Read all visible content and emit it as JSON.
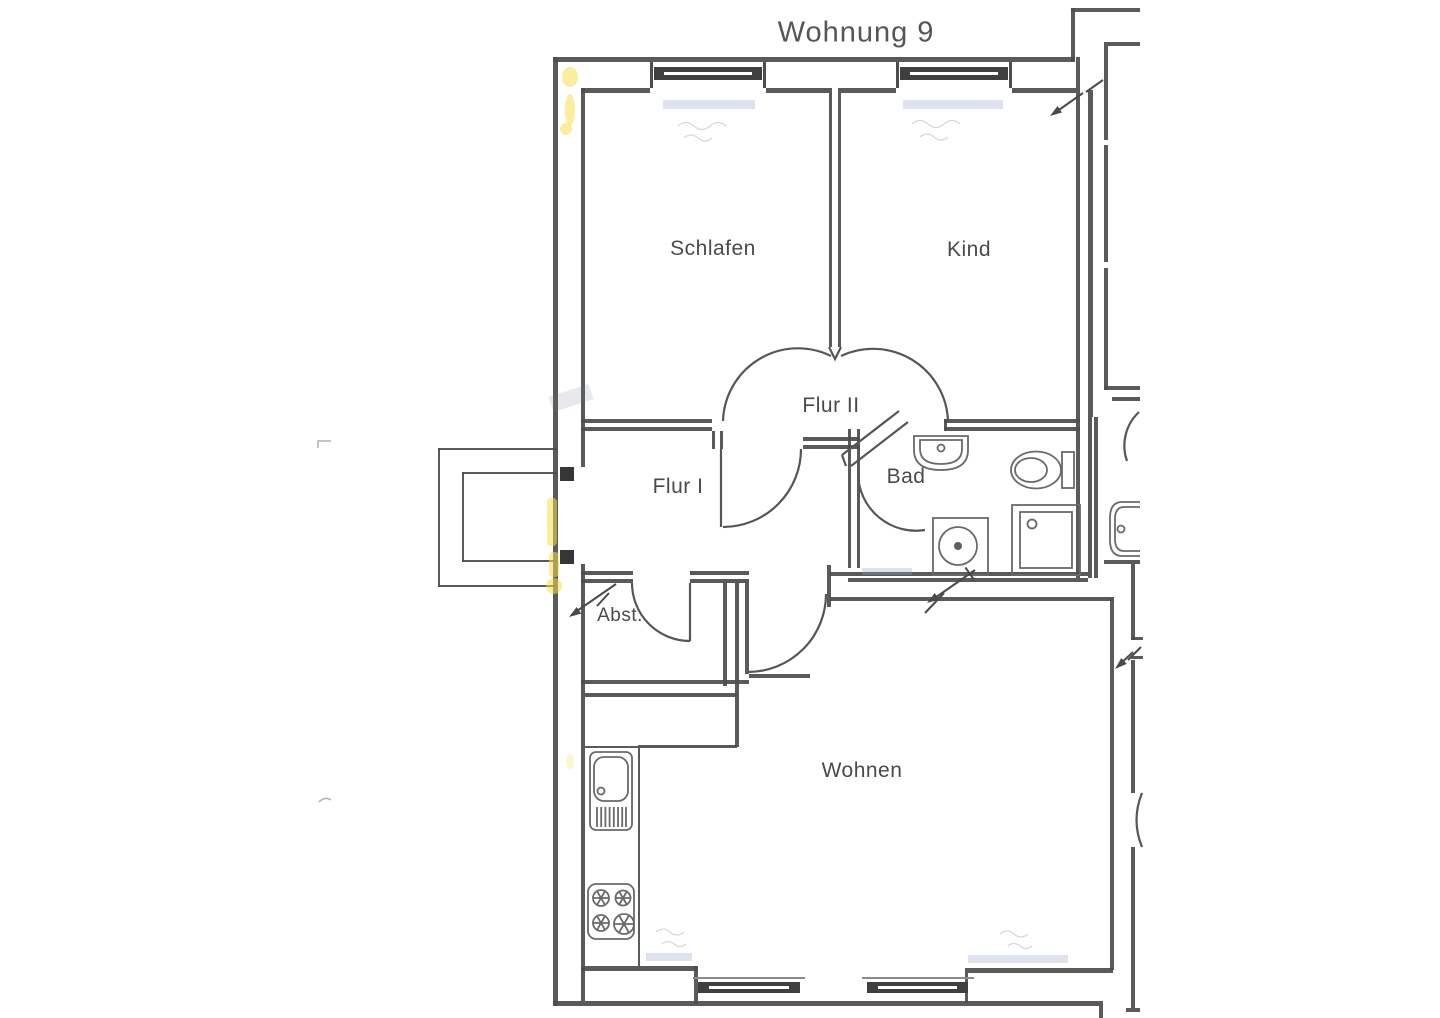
{
  "title": "Wohnung 9",
  "rooms": {
    "schlafen": {
      "label": "Schlafen"
    },
    "kind": {
      "label": "Kind"
    },
    "flur2": {
      "label": "Flur II"
    },
    "flur1": {
      "label": "Flur I"
    },
    "bad": {
      "label": "Bad"
    },
    "abst": {
      "label": "Abst."
    },
    "wohnen": {
      "label": "Wohnen"
    }
  },
  "icons": [
    {
      "name": "bathroom-sink-icon"
    },
    {
      "name": "toilet-icon"
    },
    {
      "name": "shower-icon"
    },
    {
      "name": "washing-machine-icon"
    },
    {
      "name": "kitchen-sink-icon"
    },
    {
      "name": "stove-icon"
    },
    {
      "name": "neighbor-sink-icon"
    },
    {
      "name": "entrance-arrow-icon"
    }
  ],
  "colors": {
    "ink": "#4e4e4e",
    "fixture_ink": "#6a6a6a",
    "window_glazing": "#3f3f3f",
    "highlighter_yellow": "#f5e04a",
    "faded_blue": "#9aa8cf",
    "paper": "#ffffff"
  }
}
